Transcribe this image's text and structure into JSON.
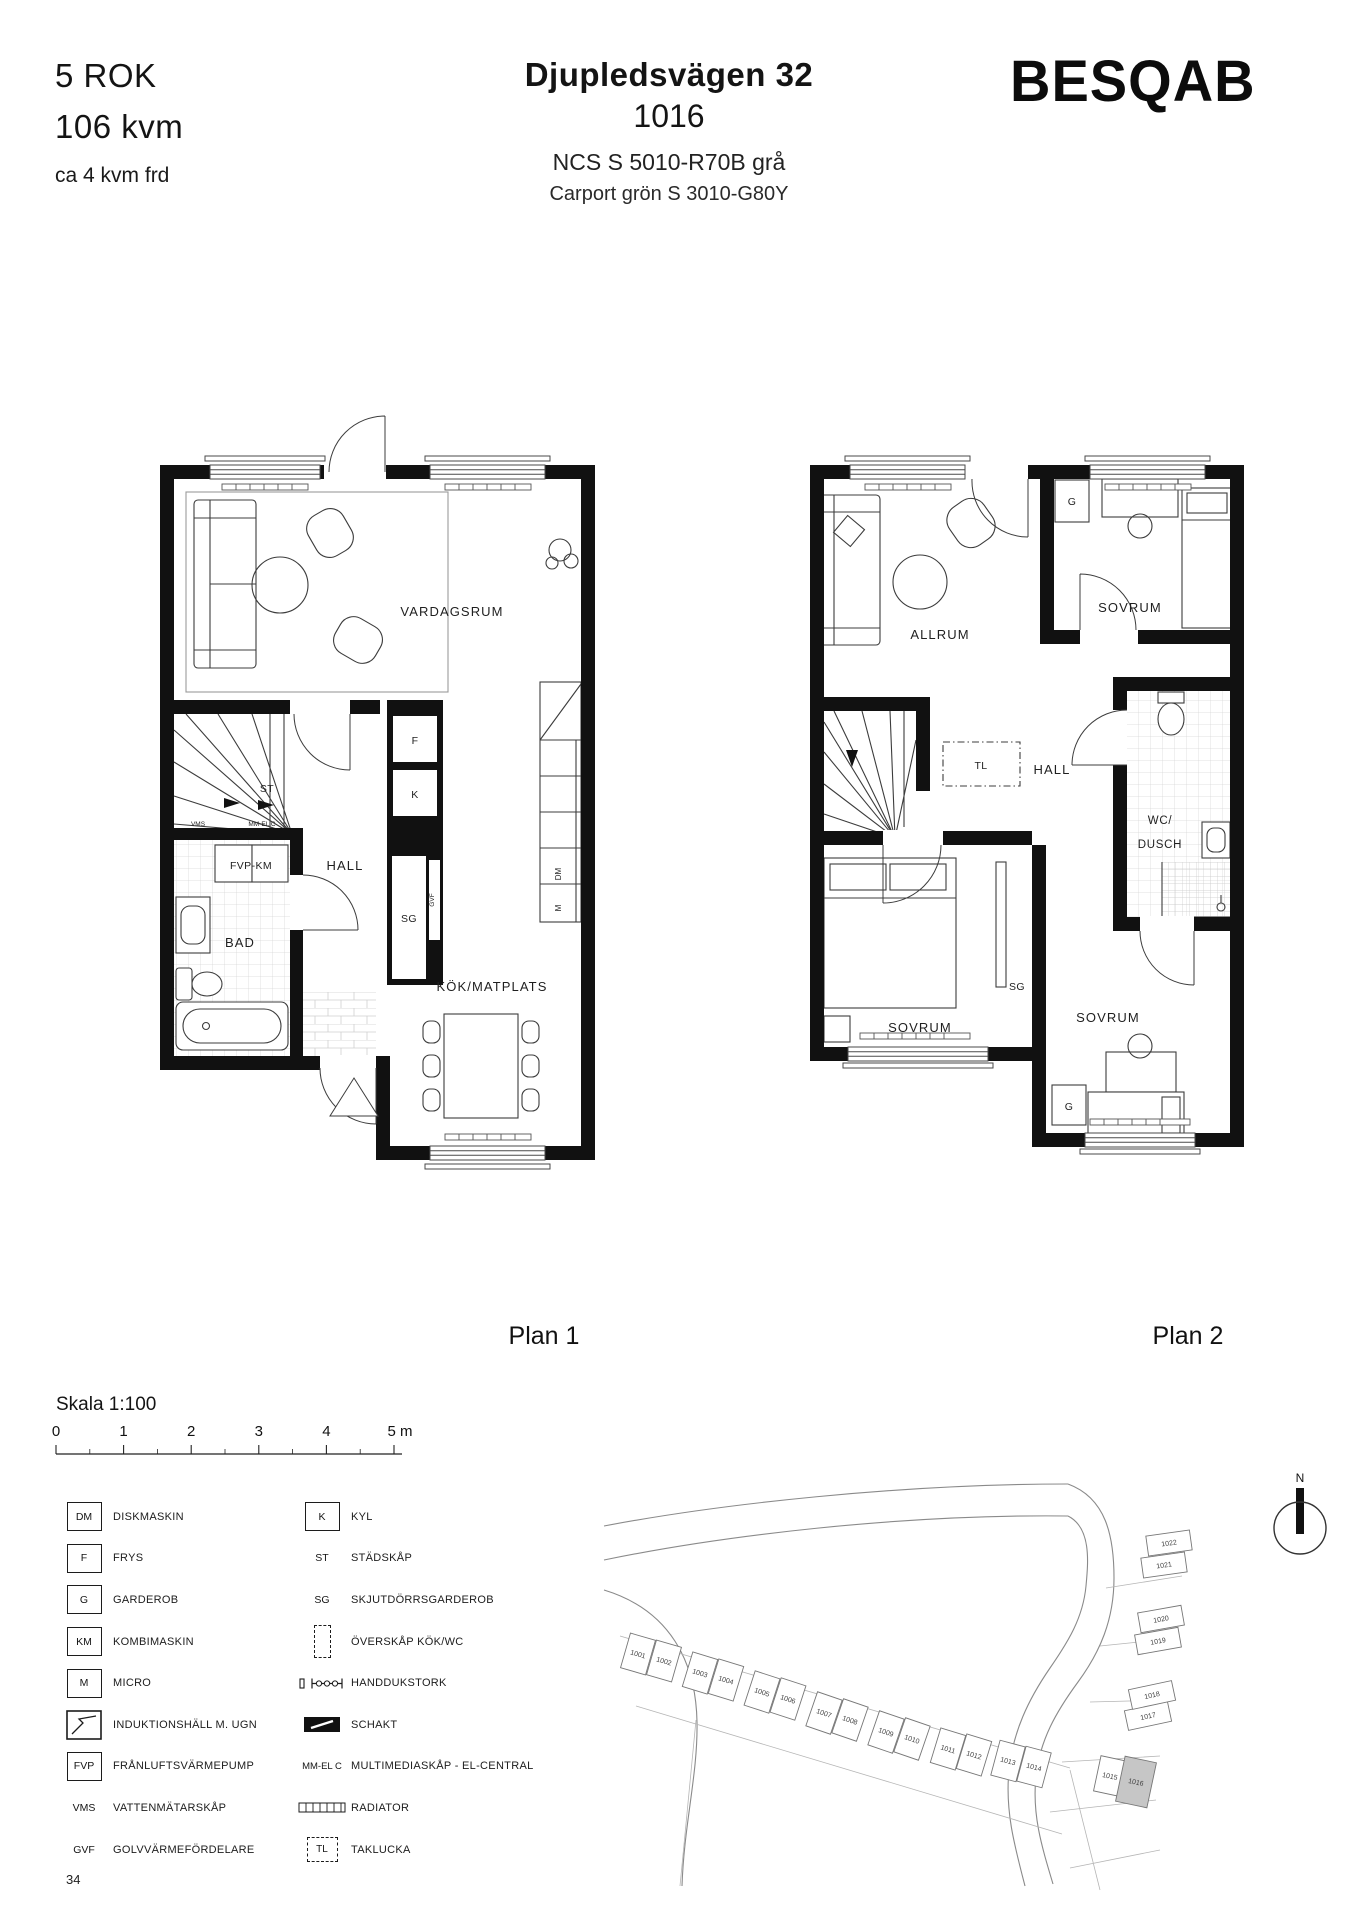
{
  "header": {
    "rok": "5 ROK",
    "area": "106 kvm",
    "frd": "ca 4 kvm frd",
    "address": "Djupledsvägen 32",
    "unit_number": "1016",
    "facade_color": "NCS S 5010-R70B grå",
    "carport_color": "Carport grön S 3010-G80Y",
    "brand": "BESQAB"
  },
  "plan1": {
    "caption": "Plan 1",
    "labels": {
      "vardagsrum": "VARDAGSRUM",
      "hall": "HALL",
      "bad": "BAD",
      "kok": "KÖK/MATPLATS",
      "fvp_km": "FVP-KM",
      "st": "ST",
      "vms": "VMS",
      "mm_el_c": "MM-EL C",
      "f": "F",
      "k": "K",
      "sg": "SG",
      "gvf": "GVF",
      "dm": "DM",
      "m": "M"
    }
  },
  "plan2": {
    "caption": "Plan 2",
    "labels": {
      "allrum": "ALLRUM",
      "sovrum_1": "SOVRUM",
      "sovrum_2": "SOVRUM",
      "sovrum_3": "SOVRUM",
      "g_1": "G",
      "g_2": "G",
      "tl": "TL",
      "hall": "HALL",
      "wc_line1": "WC/",
      "wc_line2": "DUSCH",
      "sg": "SG"
    }
  },
  "scale": {
    "label": "Skala 1:100",
    "ticks": [
      "0",
      "1",
      "2",
      "3",
      "4",
      "5 m"
    ]
  },
  "legend": {
    "left": [
      {
        "symbol": "DM",
        "label": "DISKMASKIN"
      },
      {
        "symbol": "F",
        "label": "FRYS"
      },
      {
        "symbol": "G",
        "label": "GARDEROB"
      },
      {
        "symbol": "KM",
        "label": "KOMBIMASKIN"
      },
      {
        "symbol": "M",
        "label": "MICRO"
      },
      {
        "icon": "induction-hob-oven-icon",
        "label": "INDUKTIONSHÄLL M. UGN"
      },
      {
        "symbol": "FVP",
        "label": "FRÅNLUFTSVÄRMEPUMP"
      },
      {
        "symbol": "VMS",
        "label": "VATTENMÄTARSKÅP"
      },
      {
        "symbol": "GVF",
        "label": "GOLVVÄRMEFÖRDELARE"
      }
    ],
    "right": [
      {
        "symbol": "K",
        "label": "KYL"
      },
      {
        "symbol": "ST",
        "label": "STÄDSKÅP"
      },
      {
        "symbol": "SG",
        "label": "SKJUTDÖRRSGARDEROB"
      },
      {
        "icon": "wall-cabinet-icon",
        "label": "ÖVERSKÅP KÖK/WC"
      },
      {
        "icon": "towel-rail-icon",
        "label": "HANDDUKSTORK"
      },
      {
        "icon": "shaft-icon",
        "label": "SCHAKT"
      },
      {
        "symbol": "MM-EL C",
        "label": "MULTIMEDIASKÅP - EL-CENTRAL"
      },
      {
        "icon": "radiator-icon",
        "label": "RADIATOR"
      },
      {
        "symbol": "TL",
        "label": "TAKLUCKA"
      }
    ]
  },
  "sitemap": {
    "north_label": "N",
    "highlighted_lot": "1016",
    "highlight_color": "#c6c6c6",
    "lots": [
      {
        "n": "1001",
        "x": 38,
        "y": 184,
        "r": 16,
        "w": 26,
        "h": 36
      },
      {
        "n": "1002",
        "x": 64,
        "y": 191,
        "r": 16,
        "w": 26,
        "h": 36
      },
      {
        "n": "1003",
        "x": 100,
        "y": 203,
        "r": 17,
        "w": 26,
        "h": 36
      },
      {
        "n": "1004",
        "x": 126,
        "y": 210,
        "r": 17,
        "w": 26,
        "h": 36
      },
      {
        "n": "1005",
        "x": 162,
        "y": 222,
        "r": 18,
        "w": 26,
        "h": 36
      },
      {
        "n": "1006",
        "x": 188,
        "y": 229,
        "r": 18,
        "w": 26,
        "h": 36
      },
      {
        "n": "1007",
        "x": 224,
        "y": 243,
        "r": 19,
        "w": 26,
        "h": 36
      },
      {
        "n": "1008",
        "x": 250,
        "y": 250,
        "r": 19,
        "w": 26,
        "h": 36
      },
      {
        "n": "1009",
        "x": 286,
        "y": 262,
        "r": 19,
        "w": 26,
        "h": 36
      },
      {
        "n": "1010",
        "x": 312,
        "y": 269,
        "r": 19,
        "w": 26,
        "h": 36
      },
      {
        "n": "1011",
        "x": 348,
        "y": 279,
        "r": 17,
        "w": 26,
        "h": 36
      },
      {
        "n": "1012",
        "x": 374,
        "y": 285,
        "r": 17,
        "w": 26,
        "h": 36
      },
      {
        "n": "1013",
        "x": 408,
        "y": 291,
        "r": 15,
        "w": 26,
        "h": 36
      },
      {
        "n": "1014",
        "x": 434,
        "y": 297,
        "r": 15,
        "w": 26,
        "h": 36
      },
      {
        "n": "1015",
        "x": 510,
        "y": 306,
        "r": 12,
        "w": 26,
        "h": 36
      },
      {
        "n": "1016",
        "x": 536,
        "y": 312,
        "r": 12,
        "w": 32,
        "h": 46,
        "highlight": true
      },
      {
        "n": "1017",
        "x": 548,
        "y": 246,
        "r": -12,
        "w": 44,
        "h": 20
      },
      {
        "n": "1018",
        "x": 552,
        "y": 225,
        "r": -12,
        "w": 44,
        "h": 20
      },
      {
        "n": "1019",
        "x": 558,
        "y": 171,
        "r": -10,
        "w": 44,
        "h": 20
      },
      {
        "n": "1020",
        "x": 561,
        "y": 149,
        "r": -10,
        "w": 44,
        "h": 20
      },
      {
        "n": "1021",
        "x": 564,
        "y": 95,
        "r": -8,
        "w": 44,
        "h": 20
      },
      {
        "n": "1022",
        "x": 569,
        "y": 73,
        "r": -8,
        "w": 44,
        "h": 20
      }
    ]
  },
  "footer": {
    "page_number": "34"
  }
}
